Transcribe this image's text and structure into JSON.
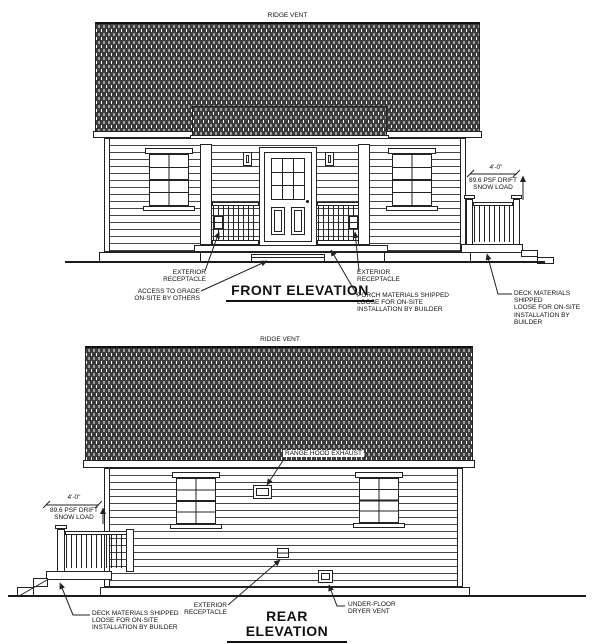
{
  "colors": {
    "line": "#222222",
    "paper": "#ffffff"
  },
  "front": {
    "ridge_vent": "RIDGE VENT",
    "title": "FRONT ELEVATION",
    "snow_dim": "4'-0\"",
    "snow_note": "89.6 PSF DRIFT\nSNOW LOAD",
    "ann_receptacle_left": "EXTERIOR\nRECEPTACLE",
    "ann_access_grade": "ACCESS TO GRADE\nON-SITE BY OTHERS",
    "ann_receptacle_right": "EXTERIOR\nRECEPTACLE",
    "ann_porch_materials": "PORCH MATERIALS SHIPPED\nLOOSE FOR ON-SITE\nINSTALLATION BY BUILDER",
    "ann_deck_materials": "DECK MATERIALS SHIPPED\nLOOSE FOR ON-SITE\nINSTALLATION BY BUILDER"
  },
  "rear": {
    "ridge_vent": "RIDGE VENT",
    "title": "REAR ELEVATION",
    "range_hood": "RANGE HOOD EXHAUST",
    "snow_dim": "4'-0\"",
    "snow_note": "89.6 PSF DRIFT\nSNOW LOAD",
    "ann_deck_materials": "DECK MATERIALS SHIPPED\nLOOSE FOR ON-SITE\nINSTALLATION BY BUILDER",
    "ann_receptacle": "EXTERIOR\nRECEPTACLE",
    "ann_dryer_vent": "UNDER-FLOOR\nDRYER VENT"
  }
}
